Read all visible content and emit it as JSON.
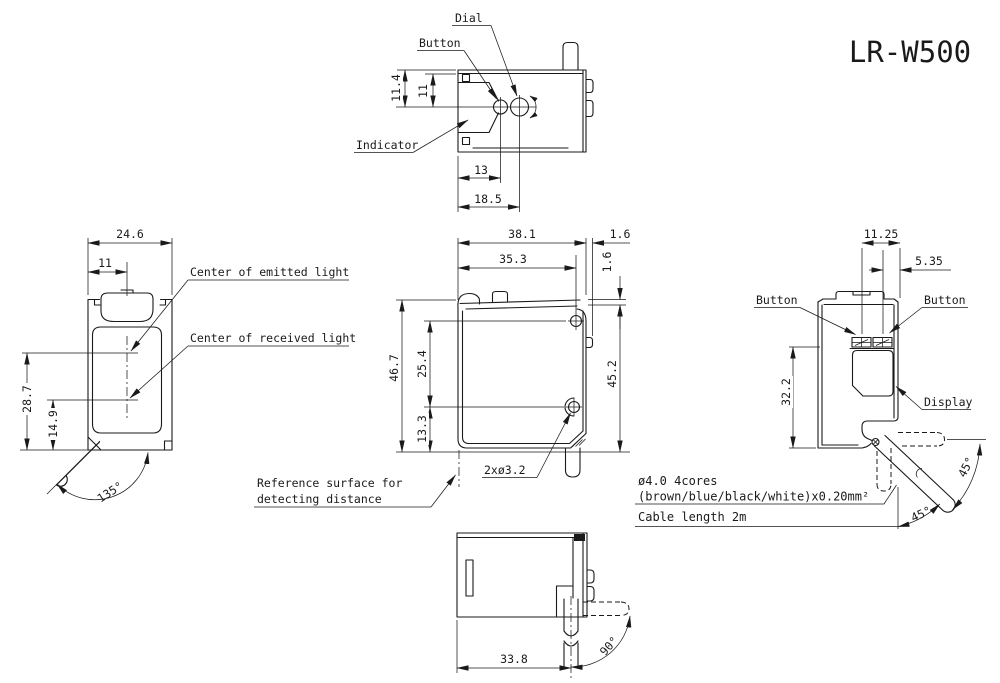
{
  "title": "LR-W500",
  "colors": {
    "line": "#1a1a1a",
    "background": "#ffffff"
  },
  "top_view": {
    "label_dial": "Dial",
    "label_button": "Button",
    "label_indicator": "Indicator",
    "dim_height_outer": "11.4",
    "dim_height_inner": "11",
    "dim_button_x": "13",
    "dim_dial_x": "18.5"
  },
  "front_view": {
    "label_emitted": "Center of emitted light",
    "label_received": "Center of received light",
    "dim_width": "24.6",
    "dim_center": "11",
    "dim_emitted_h": "28.7",
    "dim_received_h": "14.9",
    "dim_cable_angle": "135°"
  },
  "side_view": {
    "dim_width_total": "38.1",
    "dim_tab": "1.6",
    "dim_hole_x": "35.3",
    "dim_step": "1.6",
    "dim_height_total": "46.7",
    "dim_hole_pitch": "25.4",
    "dim_hole_bottom": "13.3",
    "dim_height_body": "45.2",
    "label_holes": "2xø3.2",
    "label_reference_1": "Reference surface for",
    "label_reference_2": "detecting distance"
  },
  "right_view": {
    "dim_button_x": "11.25",
    "dim_button2_x": "5.35",
    "dim_display_h": "32.2",
    "label_button_left": "Button",
    "label_button_right": "Button",
    "label_display": "Display",
    "dim_cable_angle_upper": "45°",
    "dim_cable_angle_lower": "45°"
  },
  "cable_note": {
    "line1": "ø4.0 4cores",
    "line2": "(brown/blue/black/white)x0.20mm²",
    "line3": "Cable length 2m"
  },
  "bottom_view": {
    "dim_width": "33.8",
    "dim_cable_angle": "90°"
  }
}
